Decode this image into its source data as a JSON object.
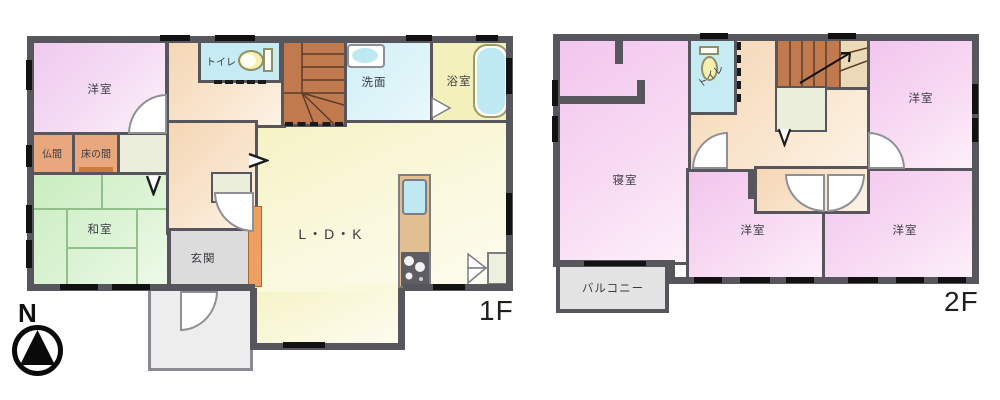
{
  "compass": {
    "north_label": "N"
  },
  "floor1": {
    "floor_label": "1F",
    "rooms": {
      "western": "洋室",
      "toilet": "トイレ",
      "washroom": "洗面",
      "bathroom": "浴室",
      "butsuma": "仏間",
      "tokonoma": "床の間",
      "japanese": "和室",
      "entrance": "玄関",
      "ldk": "L・D・K"
    }
  },
  "floor2": {
    "floor_label": "2F",
    "rooms": {
      "toilet": "トイレ",
      "bedroom": "寝室",
      "western_top": "洋室",
      "western_mid": "洋室",
      "western_right": "洋室",
      "balcony": "バルコニー"
    }
  },
  "colors": {
    "wall": "#57565c",
    "room_pink": "#efccf0",
    "room_green": "#cdeec6",
    "ldk_yellow": "#f7f4cf",
    "water_cyan": "#c7ebf3",
    "hall_peach": "#f5d6b4",
    "stairs_brown": "#c07a4e",
    "entrance_gray": "#dcdcdc",
    "balcony_gray": "#e3e3e3",
    "bath_yellow": "#f4f0bc"
  }
}
